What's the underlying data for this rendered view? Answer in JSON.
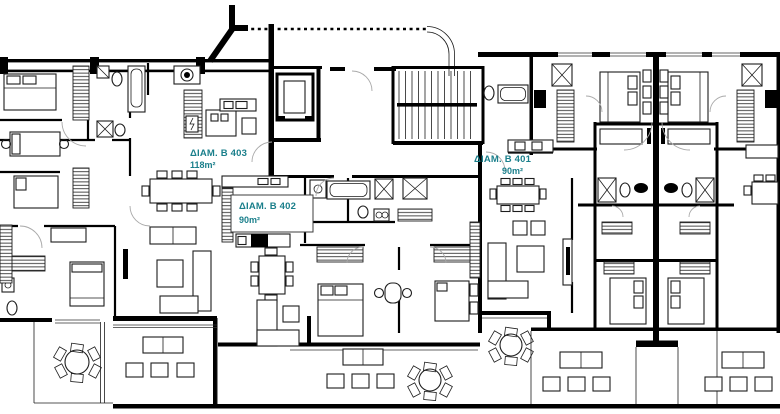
{
  "plan": {
    "apartments": [
      {
        "id": "B403",
        "label": "ΔΙΑΜ. Β 403",
        "area": "118m²"
      },
      {
        "id": "B402",
        "label": "ΔΙΑΜ. Β 402",
        "area": "90m²"
      },
      {
        "id": "B401",
        "label": "ΔΙΑΜ. Β 401",
        "area": "90m²"
      }
    ],
    "colors": {
      "label": "#1a7f8b",
      "wall": "#000000",
      "paper": "#ffffff"
    }
  }
}
